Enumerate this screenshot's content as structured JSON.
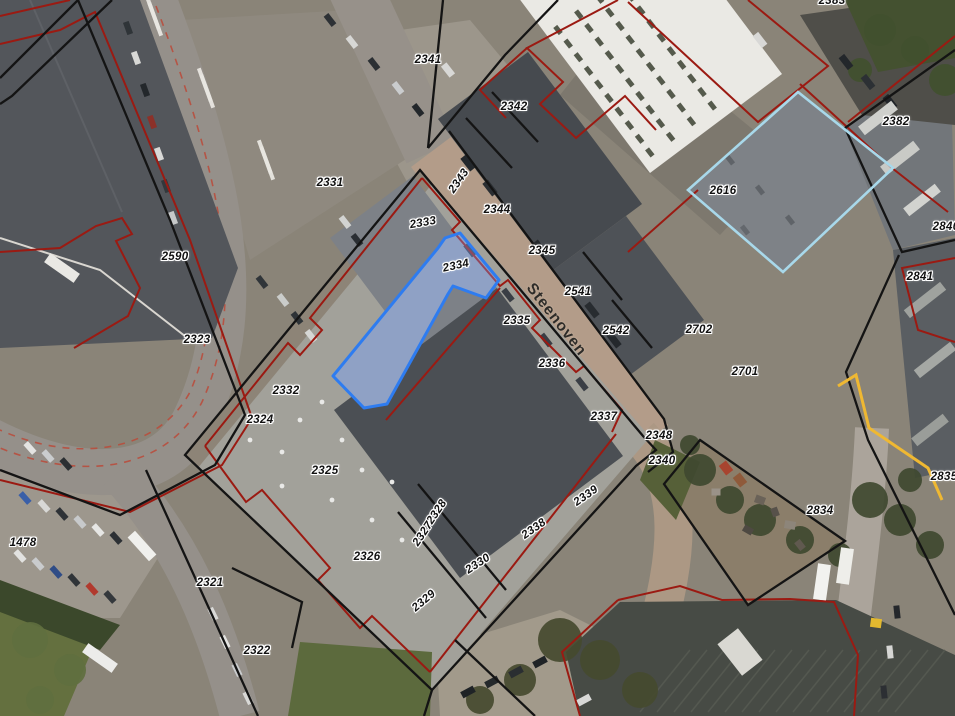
{
  "map": {
    "street_labels": [
      {
        "text": "Steenoven",
        "x": 556,
        "y": 320,
        "rotation": 52
      }
    ],
    "parcel_labels": [
      {
        "text": "2341",
        "x": 428,
        "y": 60,
        "rotation": 0
      },
      {
        "text": "2342",
        "x": 514,
        "y": 107,
        "rotation": 0
      },
      {
        "text": "2382",
        "x": 896,
        "y": 122,
        "rotation": 0
      },
      {
        "text": "2331",
        "x": 330,
        "y": 183,
        "rotation": 0
      },
      {
        "text": "2343",
        "x": 459,
        "y": 181,
        "rotation": -55
      },
      {
        "text": "2616",
        "x": 723,
        "y": 191,
        "rotation": 0
      },
      {
        "text": "2344",
        "x": 497,
        "y": 210,
        "rotation": 0
      },
      {
        "text": "2333",
        "x": 423,
        "y": 223,
        "rotation": -10
      },
      {
        "text": "2840",
        "x": 946,
        "y": 227,
        "rotation": 0
      },
      {
        "text": "2345",
        "x": 542,
        "y": 251,
        "rotation": 0
      },
      {
        "text": "2590",
        "x": 175,
        "y": 257,
        "rotation": 0
      },
      {
        "text": "2334",
        "x": 456,
        "y": 266,
        "rotation": -12
      },
      {
        "text": "2841",
        "x": 920,
        "y": 277,
        "rotation": 0
      },
      {
        "text": "2541",
        "x": 578,
        "y": 292,
        "rotation": 0
      },
      {
        "text": "2335",
        "x": 517,
        "y": 321,
        "rotation": 0
      },
      {
        "text": "2542",
        "x": 616,
        "y": 331,
        "rotation": 0
      },
      {
        "text": "2702",
        "x": 699,
        "y": 330,
        "rotation": 0
      },
      {
        "text": "2323",
        "x": 197,
        "y": 340,
        "rotation": 0
      },
      {
        "text": "2336",
        "x": 552,
        "y": 364,
        "rotation": 0
      },
      {
        "text": "2701",
        "x": 745,
        "y": 372,
        "rotation": 0
      },
      {
        "text": "2332",
        "x": 286,
        "y": 391,
        "rotation": 0
      },
      {
        "text": "2337",
        "x": 604,
        "y": 417,
        "rotation": 0
      },
      {
        "text": "2324",
        "x": 260,
        "y": 420,
        "rotation": 0
      },
      {
        "text": "2348",
        "x": 659,
        "y": 436,
        "rotation": 0
      },
      {
        "text": "2340",
        "x": 662,
        "y": 461,
        "rotation": 0
      },
      {
        "text": "2325",
        "x": 325,
        "y": 471,
        "rotation": 0
      },
      {
        "text": "2835",
        "x": 944,
        "y": 477,
        "rotation": 0
      },
      {
        "text": "2339",
        "x": 586,
        "y": 496,
        "rotation": -35
      },
      {
        "text": "2834",
        "x": 820,
        "y": 511,
        "rotation": 0
      },
      {
        "text": "2328",
        "x": 437,
        "y": 512,
        "rotation": -56
      },
      {
        "text": "2338",
        "x": 534,
        "y": 529,
        "rotation": -35
      },
      {
        "text": "2327",
        "x": 423,
        "y": 534,
        "rotation": -56
      },
      {
        "text": "1478",
        "x": 23,
        "y": 543,
        "rotation": 0
      },
      {
        "text": "2326",
        "x": 367,
        "y": 557,
        "rotation": 0
      },
      {
        "text": "2330",
        "x": 478,
        "y": 564,
        "rotation": -33
      },
      {
        "text": "2321",
        "x": 210,
        "y": 583,
        "rotation": 0
      },
      {
        "text": "2329",
        "x": 424,
        "y": 601,
        "rotation": -40
      },
      {
        "text": "2383",
        "x": 832,
        "y": 1,
        "rotation": 0
      },
      {
        "text": "2322",
        "x": 257,
        "y": 651,
        "rotation": 0
      }
    ],
    "selected_parcel": {
      "parcel_id": "2334"
    },
    "colors": {
      "cadastral_black": "#141414",
      "cadastral_red": "#9b1a12",
      "selection_blue": "#2e7cf0",
      "selection_fill": "rgba(130,170,255,0.32)",
      "highlight_cyan": "#a8d8ea",
      "accent_yellow": "#efb832"
    }
  }
}
